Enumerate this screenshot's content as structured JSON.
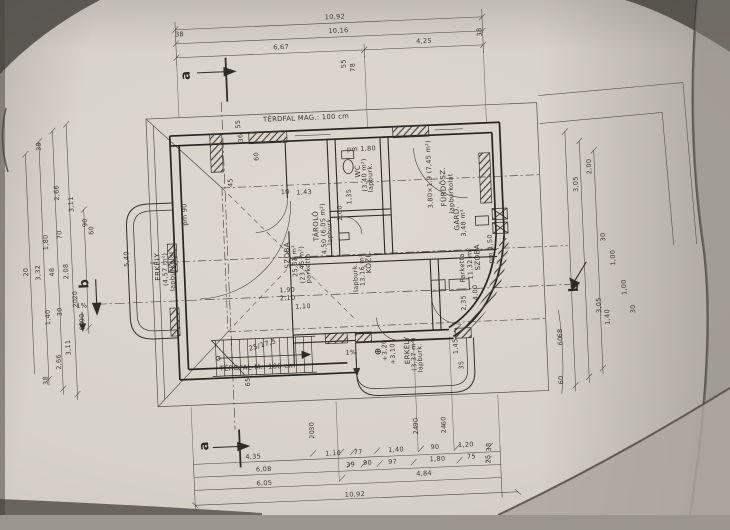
{
  "colors": {
    "paper": "#d6d1c9",
    "ink": "#3b3934"
  },
  "markers": {
    "a": "a",
    "b": "b"
  },
  "notes": {
    "knee_top": "TÉRDFAL MAG.: 100 cm",
    "knee_bottom": "TÉRDFAL M.: 100 cm",
    "stair_step": "25/17,5",
    "pm_180": "pm 1,80",
    "pm_150": "pm 1,50",
    "pm_90": "pm 90"
  },
  "levels": {
    "l1": "+3,20",
    "l2": "+3,10",
    "slope1": "1%",
    "slope2": "1%"
  },
  "rooms": [
    {
      "name": "SZOBA",
      "size": "25,61 m²",
      "size2": "(23,45 m²)",
      "floor": "parketta"
    },
    {
      "name": "TÁROLÓ",
      "size": "4,50 (6,05 m²)",
      "floor": "lapburk."
    },
    {
      "name": "WC",
      "size": "(3,40 m²)",
      "floor": "lapburk."
    },
    {
      "name": "FÜRDŐSZ.",
      "size": "3,80×1,9 (7,45 m²)",
      "floor": "lapburkolat"
    },
    {
      "name": "GARD.",
      "size": "3,48 m²"
    },
    {
      "name": "SZOBA",
      "size": "11,32 m²",
      "floor": "Parketta"
    },
    {
      "name": "KÖZL.",
      "size": "13,16 m²",
      "floor": "lapburk."
    },
    {
      "name": "ERKÉLY",
      "size": "(4,57 m²)",
      "floor": "lapburkolat"
    },
    {
      "name": "ERKÉLY",
      "size": "(3,37 m²)",
      "floor": "lapburk."
    }
  ],
  "dims": [
    "10,92",
    "10,16",
    "6,67",
    "4,25",
    "38",
    "38",
    "38",
    "2,66",
    "3,11",
    "90",
    "60",
    "70",
    "1,80",
    "20",
    "3,32",
    "48",
    "2,08",
    "20",
    "20",
    "30",
    "1,40",
    "90",
    "60",
    "3,11",
    "2,66",
    "38",
    "2,00",
    "3,05",
    "30",
    "1,00",
    "1,00",
    "30",
    "68",
    "60",
    "3,05",
    "1,40",
    "60",
    "4,35",
    "1,10",
    "77",
    "1,40",
    "90",
    "1,20",
    "38",
    "6,08",
    "39",
    "90",
    "97",
    "1,80",
    "75",
    "25",
    "6,05",
    "4,84",
    "10,92",
    "30",
    "20",
    "90",
    "24",
    "60",
    "24",
    "55",
    "78",
    "55",
    "36",
    "60",
    "45",
    "10",
    "1,43",
    "5,40",
    "2,00",
    "1,90",
    "2,10",
    "1,10",
    "4,00",
    "2,35",
    "1,45",
    "35",
    "65",
    "1,35"
  ]
}
